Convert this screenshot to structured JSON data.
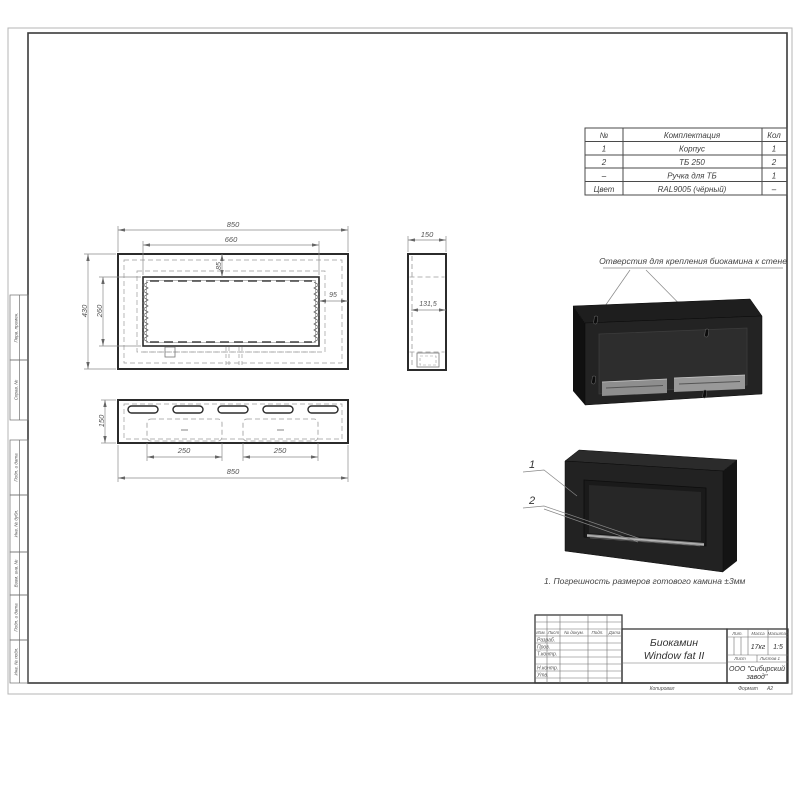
{
  "sheet": {
    "frame_stamps": [
      "Перв. примен.",
      "Справ. №",
      "Подп. и дата",
      "Инв. № дубл.",
      "Взам. инв. №",
      "Подп. и дата",
      "Инв. № подл."
    ],
    "kopiroval": "Копировал",
    "format_label": "Формат",
    "format_value": "А2"
  },
  "parts_table": {
    "headers": [
      "№",
      "Комплектация",
      "Кол"
    ],
    "rows": [
      [
        "1",
        "Корпус",
        "1"
      ],
      [
        "2",
        "ТБ 250",
        "2"
      ],
      [
        "–",
        "Ручка для ТБ",
        "1"
      ],
      [
        "Цвет",
        "RAL9005 (чёрный)",
        "–"
      ]
    ]
  },
  "dimensions": {
    "front": {
      "overall_width": "850",
      "opening_width": "660",
      "top_offset": "85",
      "side_offset": "95",
      "overall_height": "430",
      "opening_height": "260"
    },
    "side": {
      "depth": "150",
      "inner_depth": "131,5"
    },
    "top": {
      "burner_left": "250",
      "burner_right": "250",
      "overall_width": "850",
      "depth": "150"
    }
  },
  "annotations": {
    "mounting_holes": "Отверстия для крепления биокамина к стене",
    "note": "1. Погрешность размеров готового камина ±3мм",
    "callout_body": "1",
    "callout_burner": "2"
  },
  "title_block": {
    "doc_name_line1": "Биокамин",
    "doc_name_line2": "Window fat II",
    "mass": "17кг",
    "scale": "1:5",
    "company_line1": "ООО \"Сибирский",
    "company_line2": "завод\"",
    "labels": {
      "izm": "Изм.",
      "list": "Лист",
      "doc_num": "№ докум.",
      "podp": "Подп.",
      "data": "Дата",
      "razrab": "Разраб.",
      "prov": "Пров.",
      "tkontr": "Т.контр.",
      "nkontr": "Н.контр.",
      "utv": "Утв.",
      "lit": "Лит.",
      "massa": "Масса",
      "masshtab": "Масштаб",
      "sheet": "Лист",
      "sheets": "Листов 1"
    }
  },
  "colors": {
    "line_heavy": "#2b2b2b",
    "line_thin": "#8a8a8a",
    "dim_text": "#555555",
    "render_dark": "#1d1d1d",
    "render_panel": "#2d2d2d",
    "burner_silver": "#9b9b9b"
  }
}
